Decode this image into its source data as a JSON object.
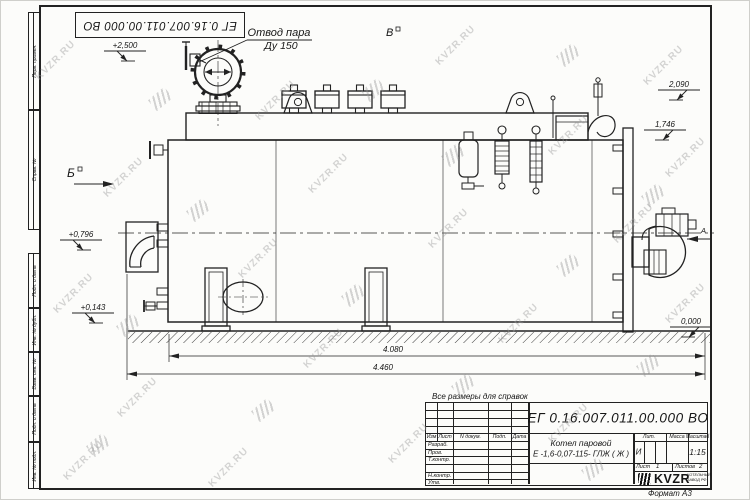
{
  "watermark": {
    "text": "KVZR.RU"
  },
  "sheet": {
    "top_stamp": "ЕГ 0.16.007.011.00.000  ВО",
    "note": "Все размеры для справок",
    "format_label": "Формат А3",
    "side_labels": [
      "Перв. примен.",
      "Справ. №",
      "Подп. и дата",
      "Инв. № дубл.",
      "Взам. инв. №",
      "Подп. и дата",
      "Инв. № подл."
    ]
  },
  "drawing": {
    "callout": {
      "line1": "Отвод пара",
      "line2": "Ду 150"
    },
    "views": {
      "b": "Б",
      "v": "В",
      "a": "А"
    },
    "elevations": {
      "e2500": "+2,500",
      "e2090": "2,090",
      "e1746": "1,746",
      "e0796": "+0,796",
      "e0143": "+0,143",
      "e0000": "0,000"
    },
    "dimensions": {
      "d4080": "4.080",
      "d4460": "4.460"
    }
  },
  "title_block": {
    "designation": "ЕГ 0.16.007.011.00.000  ВО",
    "product_line1": "Котел паровой",
    "product_line2": "Е -1,6-0,07-115- ГЛЖ ( Ж )",
    "header": {
      "izm": "Изм",
      "list": "Лист",
      "doc": "N докум.",
      "sign": "Подп.",
      "date": "Дата"
    },
    "rows": [
      "Разраб.",
      "Пров.",
      "Т.контр.",
      "Н.контр.",
      "Утв."
    ],
    "lit_label": "Лит.",
    "lit_value": "И",
    "mass_label": "Масса",
    "scale_label": "Масштаб",
    "scale_value": "1:15",
    "sheet_label": "Лист",
    "sheet_value": "1",
    "sheets_label": "Листов",
    "sheets_value": "2",
    "logo_text": "KVZR",
    "logo_sub1": "КОТЕЛЬНЫЙ",
    "logo_sub2": "ЗАВОД РФ"
  }
}
